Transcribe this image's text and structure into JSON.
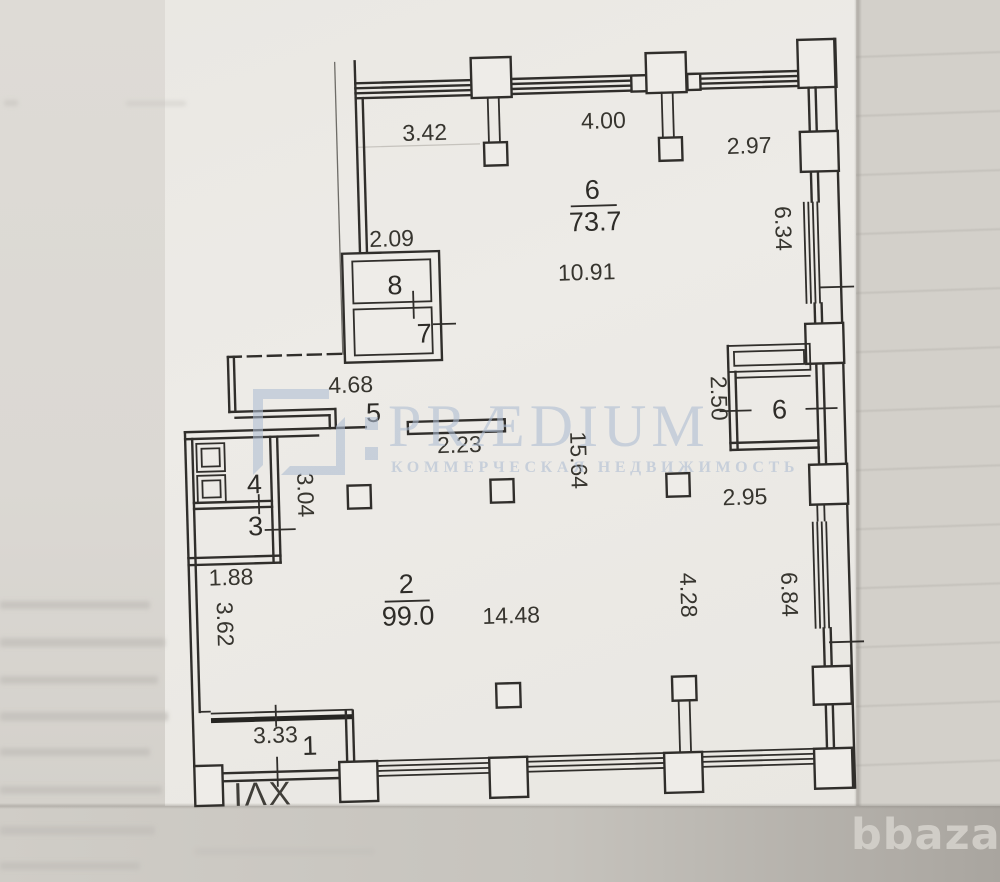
{
  "plan": {
    "section_label": "IΛX",
    "rooms": {
      "hall_top": {
        "number": "6",
        "area": "73.7"
      },
      "hall_main": {
        "number": "2",
        "area": "99.0"
      },
      "room8": {
        "number": "8"
      },
      "room7": {
        "number": "7"
      },
      "room5": {
        "number": "5"
      },
      "room4": {
        "number": "4"
      },
      "room3": {
        "number": "3"
      },
      "room1": {
        "number": "1"
      },
      "room6_side": {
        "number": "6"
      }
    },
    "dimensions": {
      "top_left": "3.42",
      "top_mid": "4.00",
      "top_right": "2.97",
      "hall_top_width": "10.91",
      "room8_width": "2.09",
      "right_upper": "6.34",
      "corridor_width": "4.68",
      "island_wall": "2.23",
      "room6_side_width": "2.50",
      "right_mid": "2.95",
      "hall_depth": "15.64",
      "left_mid": "3.04",
      "left_shaft": "1.88",
      "left_lower": "3.62",
      "hall_main_width": "14.48",
      "col_bay": "4.28",
      "right_lower": "6.84",
      "room1_width": "3.33"
    }
  },
  "watermark": {
    "brand": "PRÆDIUM",
    "tagline": "КОММЕРЧЕСКАЯ НЕДВИЖИМОСТЬ",
    "color": "#aebdd3"
  },
  "photo_watermark": {
    "text": "bbaza",
    "color": "#d2cfc9"
  }
}
